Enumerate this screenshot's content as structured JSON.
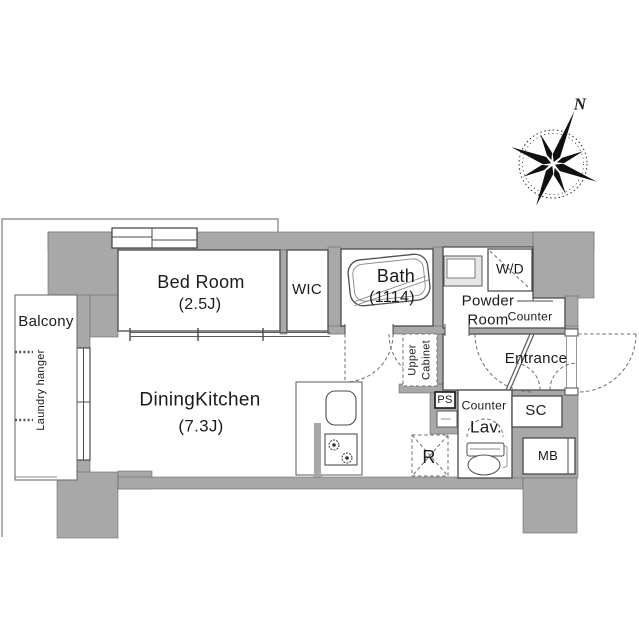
{
  "plan": {
    "compass": {
      "north": "N"
    },
    "rooms": {
      "bed_room": {
        "name": "Bed Room",
        "size": "(2.5J)"
      },
      "wic": {
        "name": "WIC"
      },
      "bath": {
        "name": "Bath",
        "size": "(1114)"
      },
      "powder_room": {
        "name_line1": "Powder",
        "name_line2": "Room"
      },
      "dining_kitchen": {
        "name": "DiningKitchen",
        "size": "(7.3J)"
      },
      "entrance": {
        "name": "Entrance"
      },
      "balcony": {
        "name": "Balcony",
        "laundry_hanger": "Laundry hanger"
      }
    },
    "features": {
      "wd": "W/D",
      "counter_powder": "Counter",
      "upper_cabinet_line1": "Upper",
      "upper_cabinet_line2": "Cabinet",
      "ps": "PS",
      "lav_counter": "Counter",
      "lav": "Lav.",
      "sc": "SC",
      "mb": "MB",
      "refrigerator": "R"
    },
    "colors": {
      "wall": "#a8a8a8",
      "outline": "#4f4f4f"
    }
  }
}
